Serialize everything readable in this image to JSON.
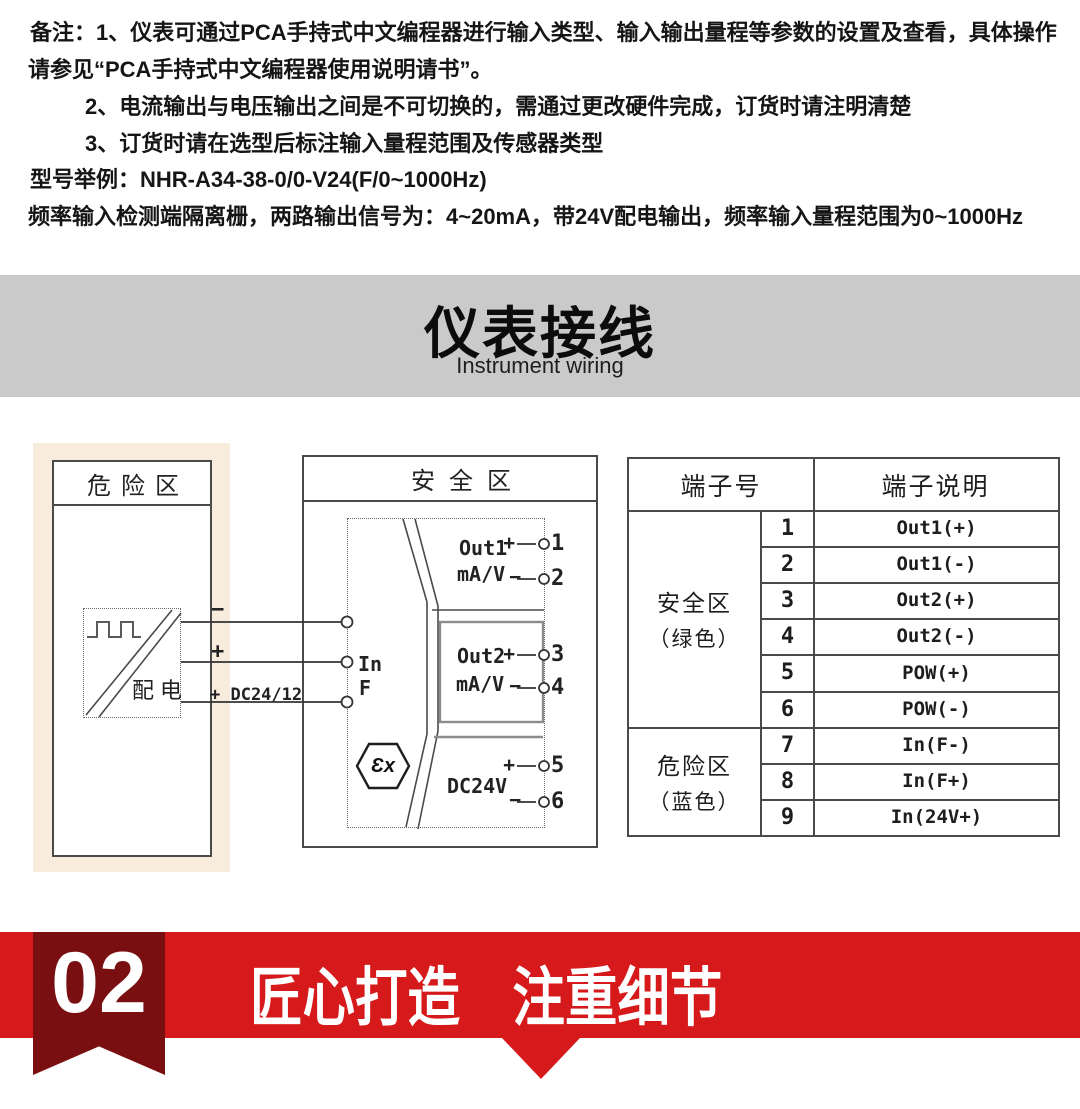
{
  "notes": {
    "line1": "备注：1、仪表可通过PCA手持式中文编程器进行输入类型、输入输出量程等参数的设置及查看，具体操作",
    "line2": "请参见“PCA手持式中文编程器使用说明请书”。",
    "line3": "2、电流输出与电压输出之间是不可切换的，需通过更改硬件完成，订货时请注明清楚",
    "line4": "3、订货时请在选型后标注输入量程范围及传感器类型",
    "line5": "型号举例：NHR-A34-38-0/0-V24(F/0~1000Hz)",
    "line6": "频率输入检测端隔离栅，两路输出信号为：4~20mA，带24V配电输出，频率输入量程范围为0~1000Hz"
  },
  "section_banner": {
    "title": "仪表接线",
    "subtitle": "Instrument wiring"
  },
  "diagram": {
    "hazard": {
      "title": "危险区",
      "device_label": "配电",
      "wire_minus": "−",
      "wire_plus": "+",
      "wire_power": "+ DC24/12V",
      "terminals": [
        "7",
        "8",
        "9"
      ]
    },
    "safe": {
      "title": "安全区",
      "input_line1": "In",
      "input_line2": "F",
      "out1_name": "Out1",
      "out1_unit": "mA/V",
      "out2_name": "Out2",
      "out2_unit": "mA/V",
      "power_name": "DC24V",
      "plus": "+",
      "minus": "−",
      "ex_mark": "Ɛx",
      "terminals": [
        "1",
        "2",
        "3",
        "4",
        "5",
        "6"
      ]
    }
  },
  "terminal_table": {
    "header_no": "端子号",
    "header_desc": "端子说明",
    "groups": [
      {
        "line1": "安全区",
        "line2": "（绿色）"
      },
      {
        "line1": "危险区",
        "line2": "（蓝色）"
      }
    ],
    "rows": [
      {
        "num": "1",
        "desc": "Out1(+)"
      },
      {
        "num": "2",
        "desc": "Out1(-)"
      },
      {
        "num": "3",
        "desc": "Out2(+)"
      },
      {
        "num": "4",
        "desc": "Out2(-)"
      },
      {
        "num": "5",
        "desc": "POW(+)"
      },
      {
        "num": "6",
        "desc": "POW(-)"
      },
      {
        "num": "7",
        "desc": "In(F-)"
      },
      {
        "num": "8",
        "desc": "In(F+)"
      },
      {
        "num": "9",
        "desc": "In(24V+)"
      }
    ]
  },
  "footer": {
    "number": "02",
    "title": "匠心打造　注重细节"
  },
  "colors": {
    "accent_red": "#d6191b",
    "ribbon_dark_red": "#7a0f12",
    "section_banner_gray": "#cacaca",
    "hazard_zone_bg": "#f8ecdc",
    "diagram_line": "#4a4a4a"
  }
}
